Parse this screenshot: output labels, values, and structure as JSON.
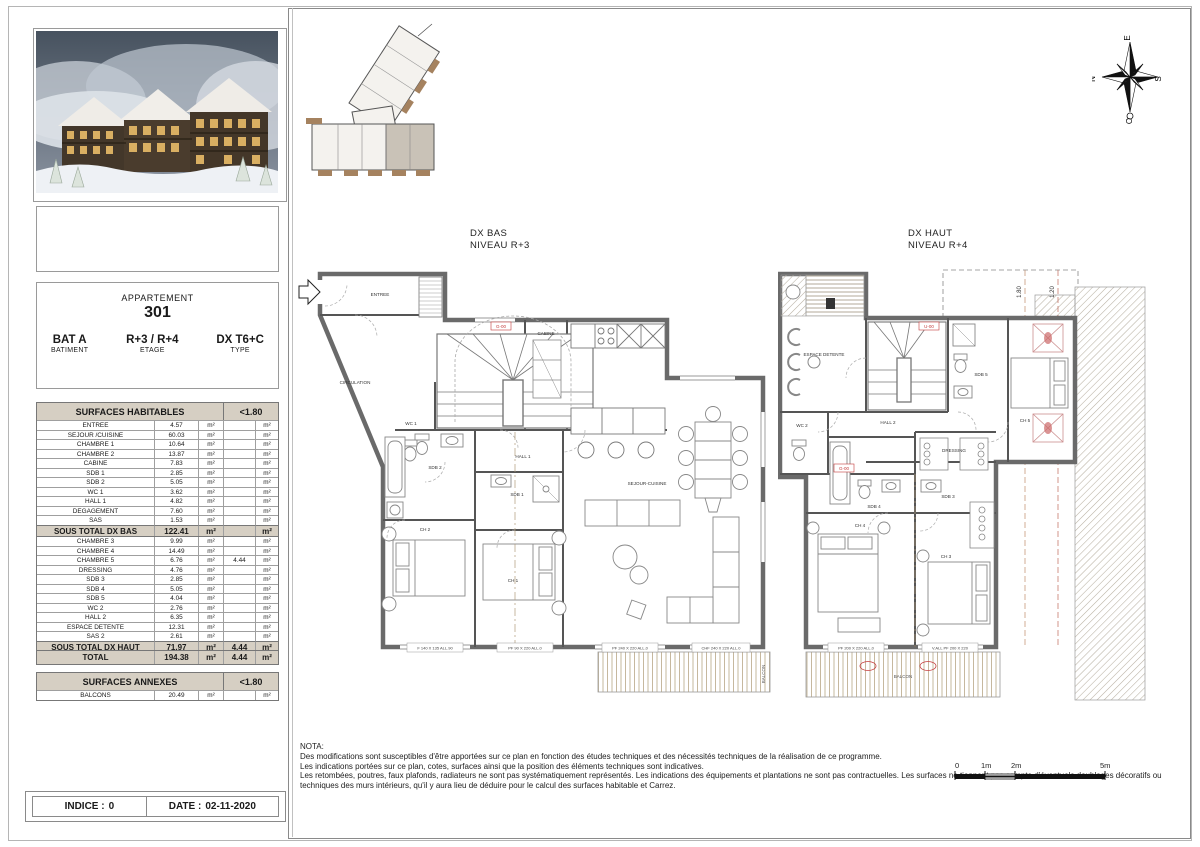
{
  "meta": {
    "indice_label": "INDICE :",
    "indice_value": "0",
    "date_label": "DATE :",
    "date_value": "02-11-2020"
  },
  "info": {
    "header": "APPARTEMENT",
    "number": "301",
    "cols": [
      {
        "value": "BAT A",
        "label": "BATIMENT"
      },
      {
        "value": "R+3 / R+4",
        "label": "ETAGE"
      },
      {
        "value": "DX T6+C",
        "label": "TYPE"
      }
    ]
  },
  "surfaces": {
    "habitables_header": "SURFACES HABITABLES",
    "lt180_header": "<1.80",
    "bas_rows": [
      [
        "ENTREE",
        "4.57",
        "m²",
        "",
        "m²"
      ],
      [
        "SEJOUR /CUISINE",
        "60.03",
        "m²",
        "",
        "m²"
      ],
      [
        "CHAMBRE 1",
        "10.64",
        "m²",
        "",
        "m²"
      ],
      [
        "CHAMBRE 2",
        "13.87",
        "m²",
        "",
        "m²"
      ],
      [
        "CABINE",
        "7.83",
        "m²",
        "",
        "m²"
      ],
      [
        "SDB 1",
        "2.85",
        "m²",
        "",
        "m²"
      ],
      [
        "SDB 2",
        "5.05",
        "m²",
        "",
        "m²"
      ],
      [
        "WC 1",
        "3.62",
        "m²",
        "",
        "m²"
      ],
      [
        "HALL 1",
        "4.82",
        "m²",
        "",
        "m²"
      ],
      [
        "DEGAGEMENT",
        "7.60",
        "m²",
        "",
        "m²"
      ],
      [
        "SAS",
        "1.53",
        "m²",
        "",
        "m²"
      ]
    ],
    "bas_total": [
      "SOUS TOTAL DX BAS",
      "122.41",
      "m²",
      "",
      "m²"
    ],
    "haut_rows": [
      [
        "CHAMBRE 3",
        "9.99",
        "m²",
        "",
        "m²"
      ],
      [
        "CHAMBRE 4",
        "14.49",
        "m²",
        "",
        "m²"
      ],
      [
        "CHAMBRE 5",
        "6.76",
        "m²",
        "4.44",
        "m²"
      ],
      [
        "DRESSING",
        "4.76",
        "m²",
        "",
        "m²"
      ],
      [
        "SDB 3",
        "2.85",
        "m²",
        "",
        "m²"
      ],
      [
        "SDB 4",
        "5.05",
        "m²",
        "",
        "m²"
      ],
      [
        "SDB 5",
        "4.04",
        "m²",
        "",
        "m²"
      ],
      [
        "WC 2",
        "2.76",
        "m²",
        "",
        "m²"
      ],
      [
        "HALL 2",
        "6.35",
        "m²",
        "",
        "m²"
      ],
      [
        "ESPACE DETENTE",
        "12.31",
        "m²",
        "",
        "m²"
      ],
      [
        "SAS 2",
        "2.61",
        "m²",
        "",
        "m²"
      ]
    ],
    "haut_total": [
      "SOUS TOTAL DX HAUT",
      "71.97",
      "m²",
      "4.44",
      "m²"
    ],
    "total_row": [
      "TOTAL",
      "194.38",
      "m²",
      "4.44",
      "m²"
    ],
    "annexes_header": "SURFACES ANNEXES",
    "annexes_rows": [
      [
        "BALCONS",
        "20.49",
        "m²",
        "",
        "m²"
      ]
    ]
  },
  "plans": {
    "bas": {
      "title": "DX BAS",
      "subtitle": "NIVEAU R+3",
      "rooms": [
        "ENTREE",
        "CIRCULATION",
        "CABINE",
        "WC 1",
        "SDB 2",
        "SDB 1",
        "CH 2",
        "CH 1",
        "HALL 1",
        "SEJOUR-CUISINE"
      ],
      "windows": [
        "F 140 X 135 ALL.90",
        "PF 90 X 220 ALL.0",
        "PF 240 X 220 ALL.0",
        "CHF 240 X 220 ALL.0"
      ],
      "tags": [
        "G-00"
      ],
      "balcony": "BALCON"
    },
    "haut": {
      "title": "DX HAUT",
      "subtitle": "NIVEAU R+4",
      "rooms": [
        "ESPACE DETENTE",
        "WC 2",
        "HALL 2",
        "SDB 5",
        "CH 5",
        "DRESSING",
        "SDB 3",
        "SDB 4",
        "CH 4",
        "CH 3"
      ],
      "windows": [
        "PF 200 X 220 ALL.0",
        "V.ALL PF 200 X 220"
      ],
      "tags": [
        "U-00",
        "G-00"
      ],
      "dims": [
        "1.80",
        "1.20"
      ],
      "balcony": "BALCON"
    }
  },
  "compass": {
    "n": "N",
    "e": "E",
    "s": "S",
    "o": "O"
  },
  "scalebar": {
    "ticks": [
      "0",
      "1m",
      "2m",
      "5m"
    ]
  },
  "nota": {
    "title": "NOTA:",
    "lines": [
      "Des modifications sont susceptibles d'être apportées sur ce plan en fonction des études techniques et des nécessités techniques de la réalisation de ce programme.",
      "Les indications portées sur ce plan, cotes, surfaces ainsi que la position des éléments techniques sont indicatives.",
      "Les retombées, poutres, faux plafonds, radiateurs ne sont pas systématiquement représentés. Les indications des équipements et plantations ne sont pas contractuelles. Les surfaces ne tiennent pas compte d'éventuels doublages décoratifs ou techniques des murs intérieurs, qu'il y aura lieu de déduire pour le calcul des surfaces habitable et Carrez."
    ]
  },
  "colors": {
    "table_header_bg": "#d6cfc3",
    "wall": "#6a6a6a",
    "accent_red": "#c43b3b",
    "deck": "#c6b89e"
  }
}
